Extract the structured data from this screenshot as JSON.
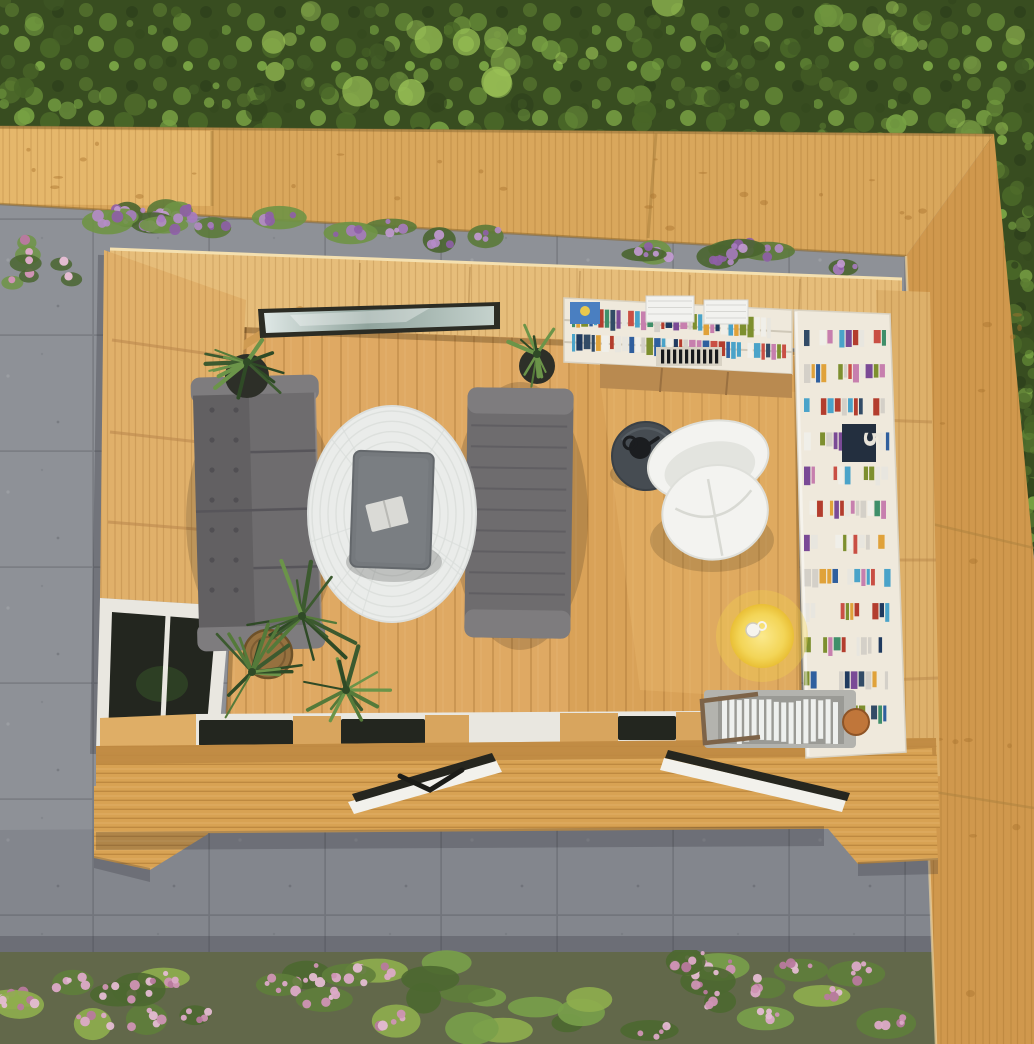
{
  "meta": {
    "title": "Aerial view of timber garden room",
    "description": "Top-down 3D render of a wooden garden office/summer house with lounge sofas, round rug, coffee table, bookshelf reading corner, open bi-fold doors onto decking, surrounded by grey paving, hedges and flower beds"
  },
  "scene": {
    "shelf_plaque_number": "5",
    "regions": {
      "hedge": "evergreen hedge",
      "top_fence": "timber fence",
      "right_fence": "timber fence",
      "paving": "grey paving slabs",
      "flower_bed": "pink flower bed",
      "flower_strip": "purple heather strip",
      "cabin": "garden room",
      "deck": "timber decking"
    },
    "objects": [
      "grey two-seat sofa",
      "grey chaise sofa",
      "round white rug",
      "grey coffee table",
      "white armchair",
      "dark round side table",
      "yellow round table with cup",
      "L-shaped bookshelf",
      "magazine rack",
      "potted spiky plants",
      "clerestory window",
      "corner window",
      "open glazed doors"
    ],
    "colors": {
      "paving": "#8e9197",
      "pavingLine": "#7b7e84",
      "hedgeBase": "#384d20",
      "hedgeLight": "#9cc457",
      "fence": "#d9a75c",
      "fenceLeft": "#e5b76b",
      "fenceRight": "#d0984d",
      "knot": "#a9742f",
      "deck": "#d8a253",
      "deckPlate": "#bf8a42",
      "wall": "#e6bd7a",
      "wallLeft": "#e0b06a",
      "wallRight": "#ddb06a",
      "floorLounge": "#dfa963",
      "floorReading": "#d9a258",
      "soil": "#62684a",
      "sofa": "#6e6c6e",
      "sofaLight": "#7e7c7e",
      "sofaDark": "#626062",
      "rug": "#eaecea",
      "rugLine": "#d9ddda",
      "table": "#75797d",
      "shelf": "#efe9dc",
      "cabinet": "#b98a50",
      "chair": "#f3f3f0",
      "sideTable": "#464c52",
      "yellow": "#eec93f",
      "rackBase": "#b3b3ae",
      "doorWhite": "#f2f1ec",
      "doorDark": "#26261f",
      "windowFrame": "#e9e7e0",
      "glassDark": "#23261f",
      "plaque": "#232f3f"
    },
    "palette": {
      "hedge": [
        "#4f6b2b",
        "#5d7f33",
        "#2f421c",
        "#6f943e",
        "#486527",
        "#77a143",
        "#425c26"
      ],
      "shrub": [
        "#4a6530",
        "#5b7a38",
        "#6f9445"
      ],
      "shrub2": [
        "#5f7e3b",
        "#79a04a",
        "#8fae4e",
        "#4c6830"
      ],
      "purple": [
        "#a77bc0",
        "#8f5fa8",
        "#c39ad4",
        "#b58cc9"
      ],
      "pink": [
        "#cf93b4",
        "#dcaac7",
        "#b87a9e",
        "#e4bcd2"
      ],
      "books": [
        "#c94f44",
        "#2f5f9e",
        "#e0a23a",
        "#3f8f6a",
        "#7a4a96",
        "#d4d0c8",
        "#324b66",
        "#c77fae",
        "#4aa3c9",
        "#f0efe9",
        "#7d8f2f",
        "#b33d2e",
        "#1f3a5f",
        "#e8e6df"
      ],
      "plant": [
        "#3c5a2f",
        "#547a3a",
        "#6b9449",
        "#2f4a26"
      ]
    }
  }
}
